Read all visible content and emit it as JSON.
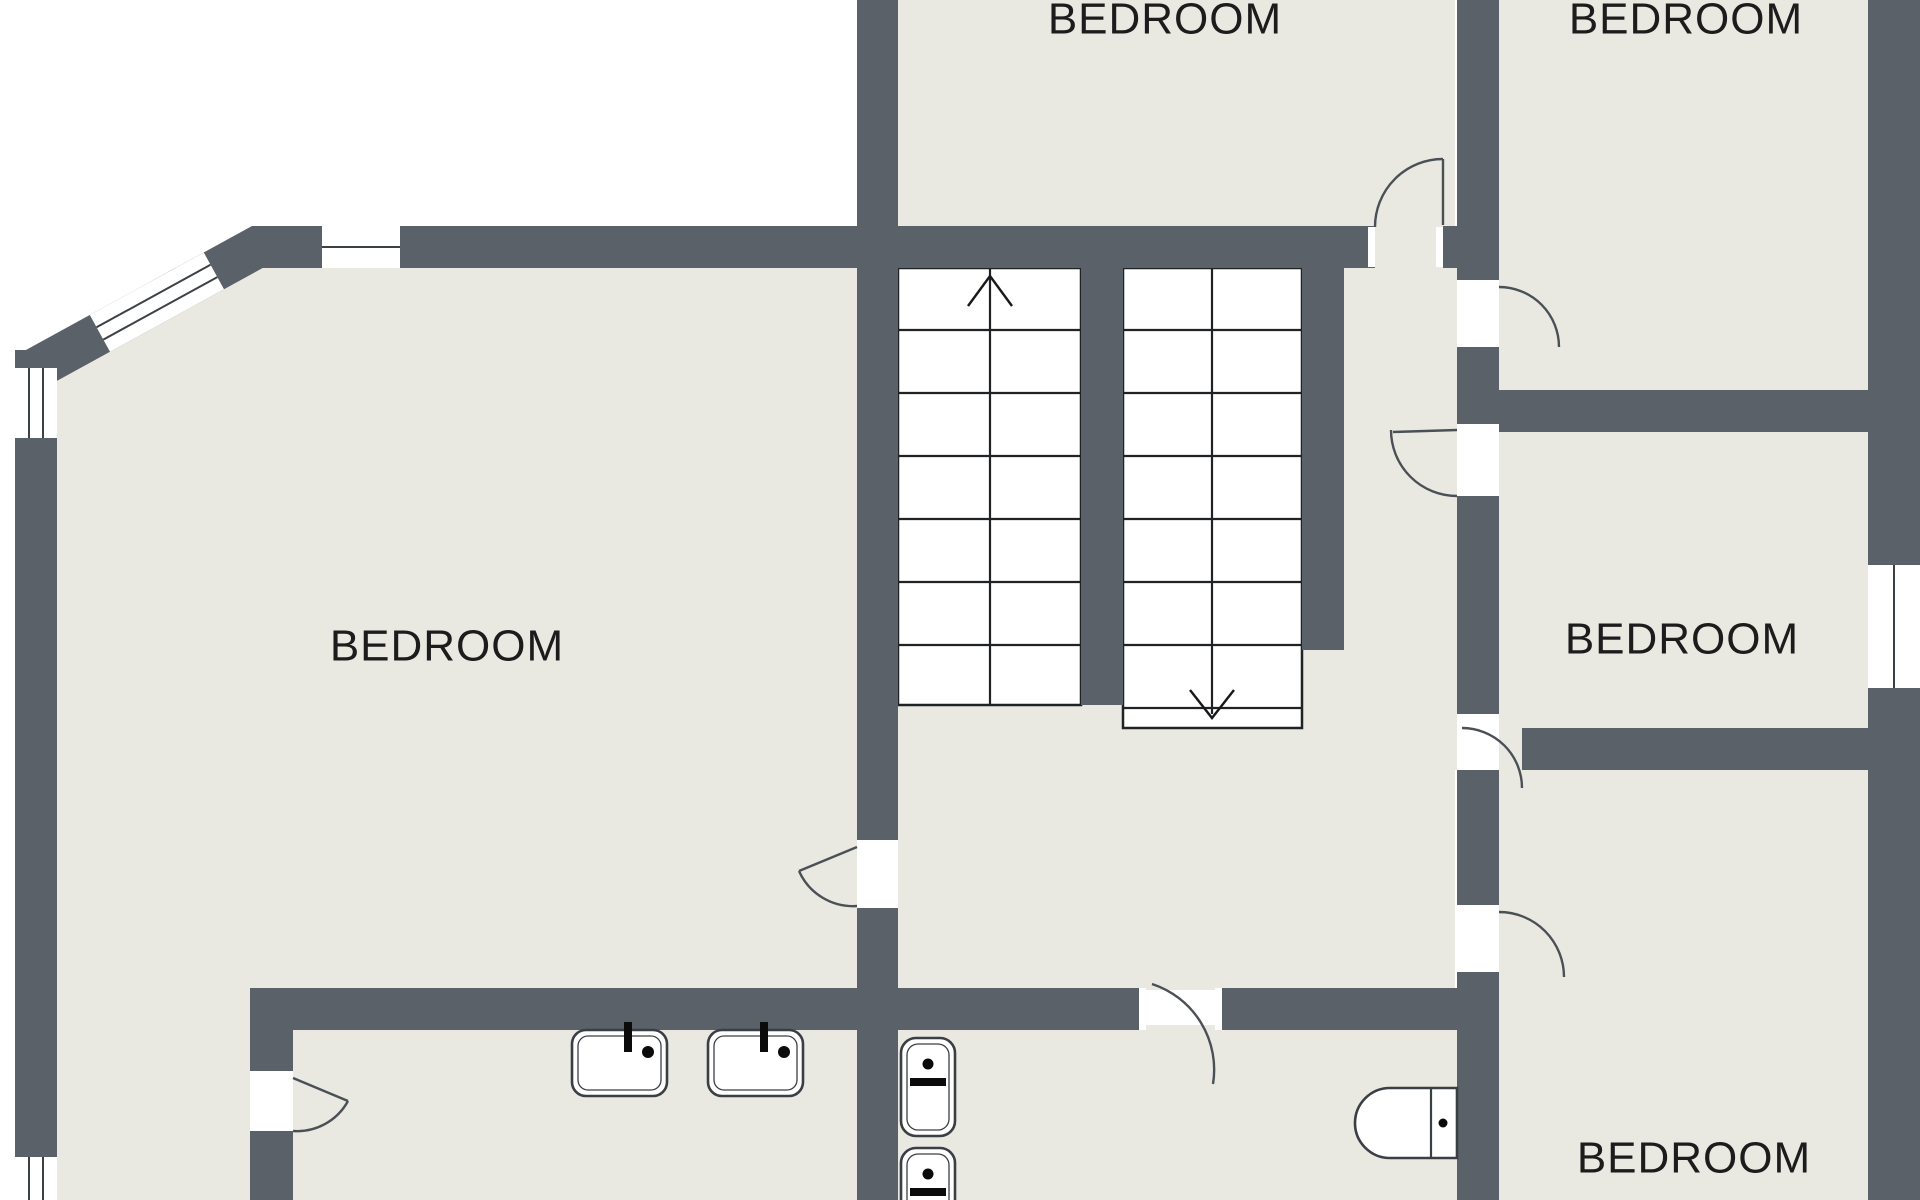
{
  "title": "First floor plan",
  "colors": {
    "wall": "#5b6168",
    "room_fill": "#e9e9e2",
    "background": "#ffffff",
    "outline": "#43484d",
    "text": "#1c1c1c"
  },
  "rooms": [
    {
      "id": "bedroom-left",
      "label": "BEDROOM"
    },
    {
      "id": "bedroom-top-middle",
      "label": "BEDROOM"
    },
    {
      "id": "bedroom-top-right",
      "label": "BEDROOM"
    },
    {
      "id": "bedroom-middle-right",
      "label": "BEDROOM"
    },
    {
      "id": "bedroom-bottom-right",
      "label": "BEDROOM"
    }
  ],
  "stairs": {
    "flights": 2,
    "left_flight_direction": "up",
    "right_flight_direction": "down"
  },
  "fixtures": [
    {
      "id": "sink-1",
      "type": "sink-icon"
    },
    {
      "id": "sink-2",
      "type": "sink-icon"
    },
    {
      "id": "toilet-1",
      "type": "toilet-icon"
    },
    {
      "id": "toilet-2",
      "type": "toilet-icon"
    },
    {
      "id": "toilet-3",
      "type": "toilet-icon"
    }
  ],
  "openings": {
    "doors": 8,
    "windows": 5
  }
}
